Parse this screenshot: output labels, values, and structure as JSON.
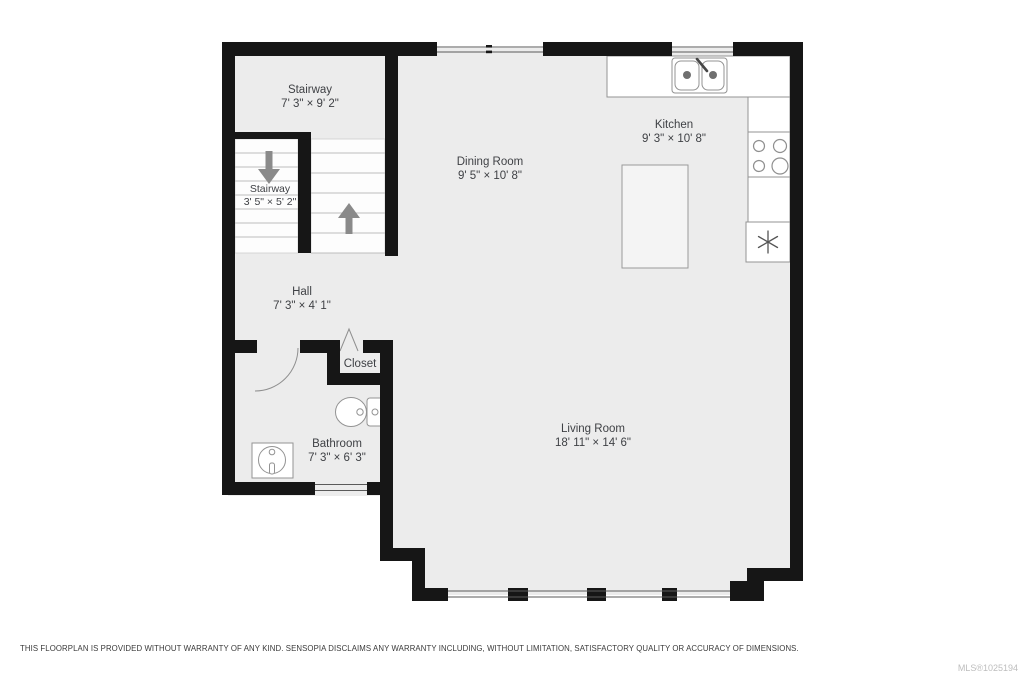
{
  "floorplan": {
    "rooms": [
      {
        "id": "stairway-upper",
        "name": "Stairway",
        "dims": "7' 3\" × 9' 2\""
      },
      {
        "id": "stairway-lower",
        "name": "Stairway",
        "dims": "3' 5\" × 5' 2\""
      },
      {
        "id": "dining-room",
        "name": "Dining Room",
        "dims": "9' 5\" × 10' 8\""
      },
      {
        "id": "kitchen",
        "name": "Kitchen",
        "dims": "9' 3\" × 10' 8\""
      },
      {
        "id": "hall",
        "name": "Hall",
        "dims": "7' 3\" × 4' 1\""
      },
      {
        "id": "closet",
        "name": "Closet",
        "dims": ""
      },
      {
        "id": "bathroom",
        "name": "Bathroom",
        "dims": "7' 3\" × 6' 3\""
      },
      {
        "id": "living-room",
        "name": "Living Room",
        "dims": "18' 11\" × 14' 6\""
      }
    ],
    "icons": [
      "kitchen-sink-icon",
      "stove-burners-icon",
      "fridge-snowflake-icon",
      "kitchen-island",
      "toilet-icon",
      "bathroom-sink-icon",
      "stair-down-arrow-icon",
      "stair-up-arrow-icon",
      "bathroom-door-arc-icon",
      "closet-door-chevron-icon",
      "window-glyphs"
    ],
    "colors": {
      "wall": "#161616",
      "floor": "#ececec",
      "fixture_stroke": "#939393",
      "arrow": "#8a8a8a",
      "label": "#3f4145",
      "disclaimer": "#3a3a3a",
      "mls": "#bdbdbd",
      "background": "#ffffff"
    }
  },
  "footer": {
    "disclaimer": "THIS FLOORPLAN IS PROVIDED WITHOUT WARRANTY OF ANY KIND. SENSOPIA DISCLAIMS ANY WARRANTY INCLUDING, WITHOUT LIMITATION, SATISFACTORY QUALITY OR ACCURACY OF DIMENSIONS.",
    "mls": "MLS®1025194"
  }
}
